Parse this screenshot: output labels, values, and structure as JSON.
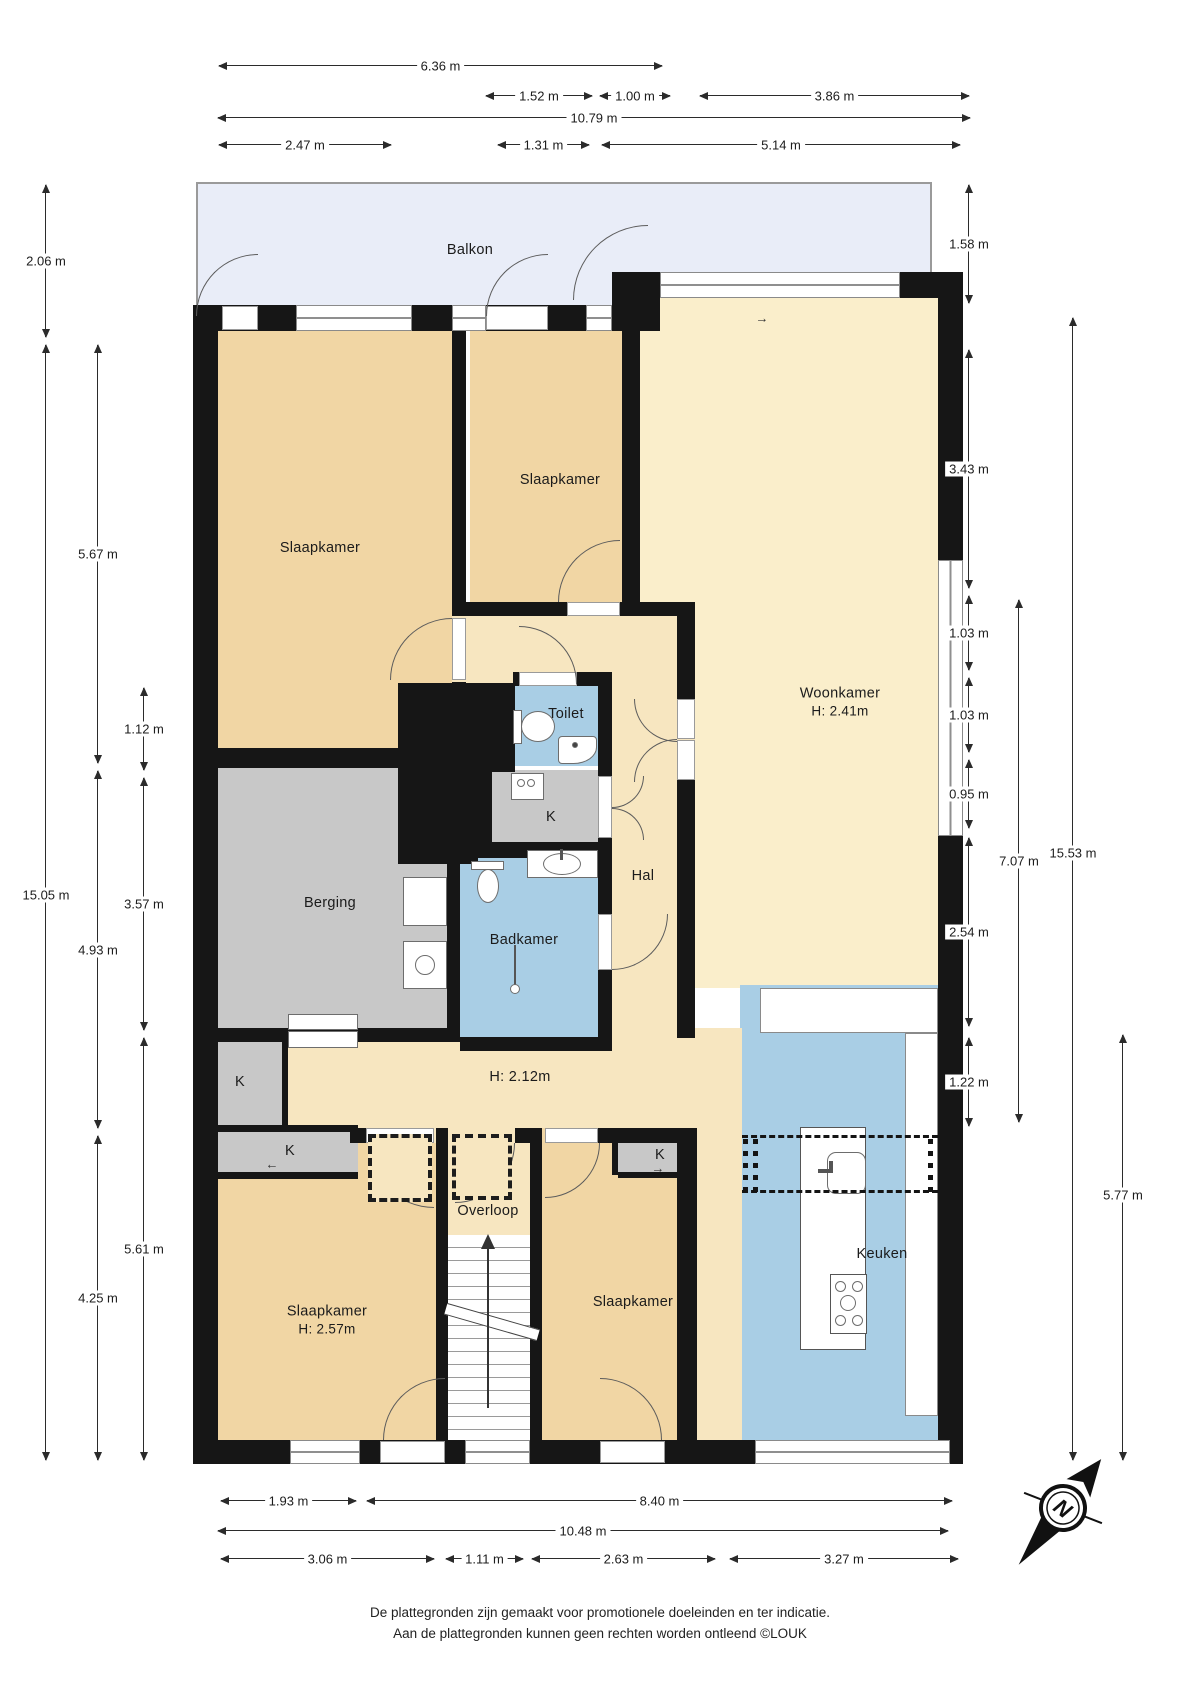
{
  "rooms": [
    {
      "name": "balkon",
      "label": "Balkon",
      "x": 470,
      "y": 250
    },
    {
      "name": "slaapkamer-top-left",
      "label": "Slaapkamer",
      "x": 320,
      "y": 548
    },
    {
      "name": "slaapkamer-top-center",
      "label": "Slaapkamer",
      "x": 560,
      "y": 480
    },
    {
      "name": "toilet",
      "label": "Toilet",
      "x": 566,
      "y": 714
    },
    {
      "name": "kast-center",
      "label": "K",
      "x": 551,
      "y": 817
    },
    {
      "name": "berging",
      "label": "Berging",
      "x": 330,
      "y": 903
    },
    {
      "name": "badkamer",
      "label": "Badkamer",
      "x": 524,
      "y": 940
    },
    {
      "name": "hal",
      "label": "Hal",
      "x": 643,
      "y": 876
    },
    {
      "name": "woonkamer",
      "label": "Woonkamer",
      "sub": "H: 2.41m",
      "x": 840,
      "y": 702
    },
    {
      "name": "hal-height",
      "label": "H: 2.12m",
      "x": 520,
      "y": 1077
    },
    {
      "name": "kast-left-upper",
      "label": "K",
      "x": 240,
      "y": 1082
    },
    {
      "name": "kast-left-lower",
      "label": "K",
      "x": 290,
      "y": 1151
    },
    {
      "name": "overloop",
      "label": "Overloop",
      "x": 488,
      "y": 1211
    },
    {
      "name": "kast-right",
      "label": "K",
      "x": 660,
      "y": 1155
    },
    {
      "name": "slaapkamer-bottom-left",
      "label": "Slaapkamer",
      "sub": "H: 2.57m",
      "x": 327,
      "y": 1320
    },
    {
      "name": "slaapkamer-bottom-right",
      "label": "Slaapkamer",
      "x": 633,
      "y": 1302
    },
    {
      "name": "keuken",
      "label": "Keuken",
      "x": 882,
      "y": 1254
    }
  ],
  "markers": [
    {
      "name": "entry-arrow",
      "sym": "→",
      "x": 762,
      "y": 318
    },
    {
      "name": "kast-strip-arrow",
      "sym": "←",
      "x": 272,
      "y": 1164
    },
    {
      "name": "kast-right-arrow",
      "sym": "→",
      "x": 658,
      "y": 1168
    }
  ],
  "dims": [
    {
      "v": "6.36 m",
      "o": "h",
      "x": 219,
      "y": 65,
      "len": 443
    },
    {
      "v": "1.52 m",
      "o": "h",
      "x": 486,
      "y": 95,
      "len": 106
    },
    {
      "v": "1.00 m",
      "o": "h",
      "x": 600,
      "y": 95,
      "len": 70
    },
    {
      "v": "3.86 m",
      "o": "h",
      "x": 700,
      "y": 95,
      "len": 269
    },
    {
      "v": "10.79 m",
      "o": "h",
      "x": 218,
      "y": 117,
      "len": 752
    },
    {
      "v": "2.47 m",
      "o": "h",
      "x": 219,
      "y": 144,
      "len": 172
    },
    {
      "v": "1.31 m",
      "o": "h",
      "x": 498,
      "y": 144,
      "len": 91
    },
    {
      "v": "5.14 m",
      "o": "h",
      "x": 602,
      "y": 144,
      "len": 358
    },
    {
      "v": "1.93 m",
      "o": "h",
      "x": 221,
      "y": 1500,
      "len": 135
    },
    {
      "v": "8.40 m",
      "o": "h",
      "x": 367,
      "y": 1500,
      "len": 585
    },
    {
      "v": "10.48 m",
      "o": "h",
      "x": 218,
      "y": 1530,
      "len": 730
    },
    {
      "v": "3.06 m",
      "o": "h",
      "x": 221,
      "y": 1558,
      "len": 213
    },
    {
      "v": "1.11 m",
      "o": "h",
      "x": 446,
      "y": 1558,
      "len": 77
    },
    {
      "v": "2.63 m",
      "o": "h",
      "x": 532,
      "y": 1558,
      "len": 183
    },
    {
      "v": "3.27 m",
      "o": "h",
      "x": 730,
      "y": 1558,
      "len": 228
    },
    {
      "v": "2.06 m",
      "o": "v",
      "x": 45,
      "y": 185,
      "len": 152
    },
    {
      "v": "15.05 m",
      "o": "v",
      "x": 45,
      "y": 345,
      "len": 1115,
      "lp": 550
    },
    {
      "v": "5.67 m",
      "o": "v",
      "x": 97,
      "y": 345,
      "len": 418
    },
    {
      "v": "4.93 m",
      "o": "v",
      "x": 97,
      "y": 771,
      "len": 357
    },
    {
      "v": "4.25 m",
      "o": "v",
      "x": 97,
      "y": 1136,
      "len": 324
    },
    {
      "v": "1.12 m",
      "o": "v",
      "x": 143,
      "y": 688,
      "len": 82
    },
    {
      "v": "3.57 m",
      "o": "v",
      "x": 143,
      "y": 778,
      "len": 252
    },
    {
      "v": "5.61 m",
      "o": "v",
      "x": 143,
      "y": 1038,
      "len": 422
    },
    {
      "v": "1.58 m",
      "o": "v",
      "x": 968,
      "y": 185,
      "len": 118
    },
    {
      "v": "3.43 m",
      "o": "v",
      "x": 968,
      "y": 350,
      "len": 238
    },
    {
      "v": "1.03 m",
      "o": "v",
      "x": 968,
      "y": 596,
      "len": 74
    },
    {
      "v": "1.03 m",
      "o": "v",
      "x": 968,
      "y": 678,
      "len": 74
    },
    {
      "v": "0.95 m",
      "o": "v",
      "x": 968,
      "y": 760,
      "len": 68
    },
    {
      "v": "2.54 m",
      "o": "v",
      "x": 968,
      "y": 838,
      "len": 188
    },
    {
      "v": "1.22 m",
      "o": "v",
      "x": 968,
      "y": 1038,
      "len": 88
    },
    {
      "v": "7.07 m",
      "o": "v",
      "x": 1018,
      "y": 600,
      "len": 522
    },
    {
      "v": "15.53 m",
      "o": "v",
      "x": 1072,
      "y": 318,
      "len": 1142,
      "lp": 535
    },
    {
      "v": "5.77 m",
      "o": "v",
      "x": 1122,
      "y": 1035,
      "len": 425,
      "lp": 160
    }
  ],
  "disclaimer": {
    "line1": "De plattegronden zijn gemaakt voor promotionele doeleinden en ter indicatie.",
    "line2": "Aan de plattegronden kunnen geen rechten worden ontleend ©LOUK"
  },
  "compass": {
    "label": "N"
  },
  "colors": {
    "bedroom": "#f1d6a4",
    "hall": "#f7e6c0",
    "living": "#faeecb",
    "wet": "#a9cee5",
    "storage": "#c8c8c8",
    "balcony": "#e9edf8",
    "wall": "#161616"
  }
}
